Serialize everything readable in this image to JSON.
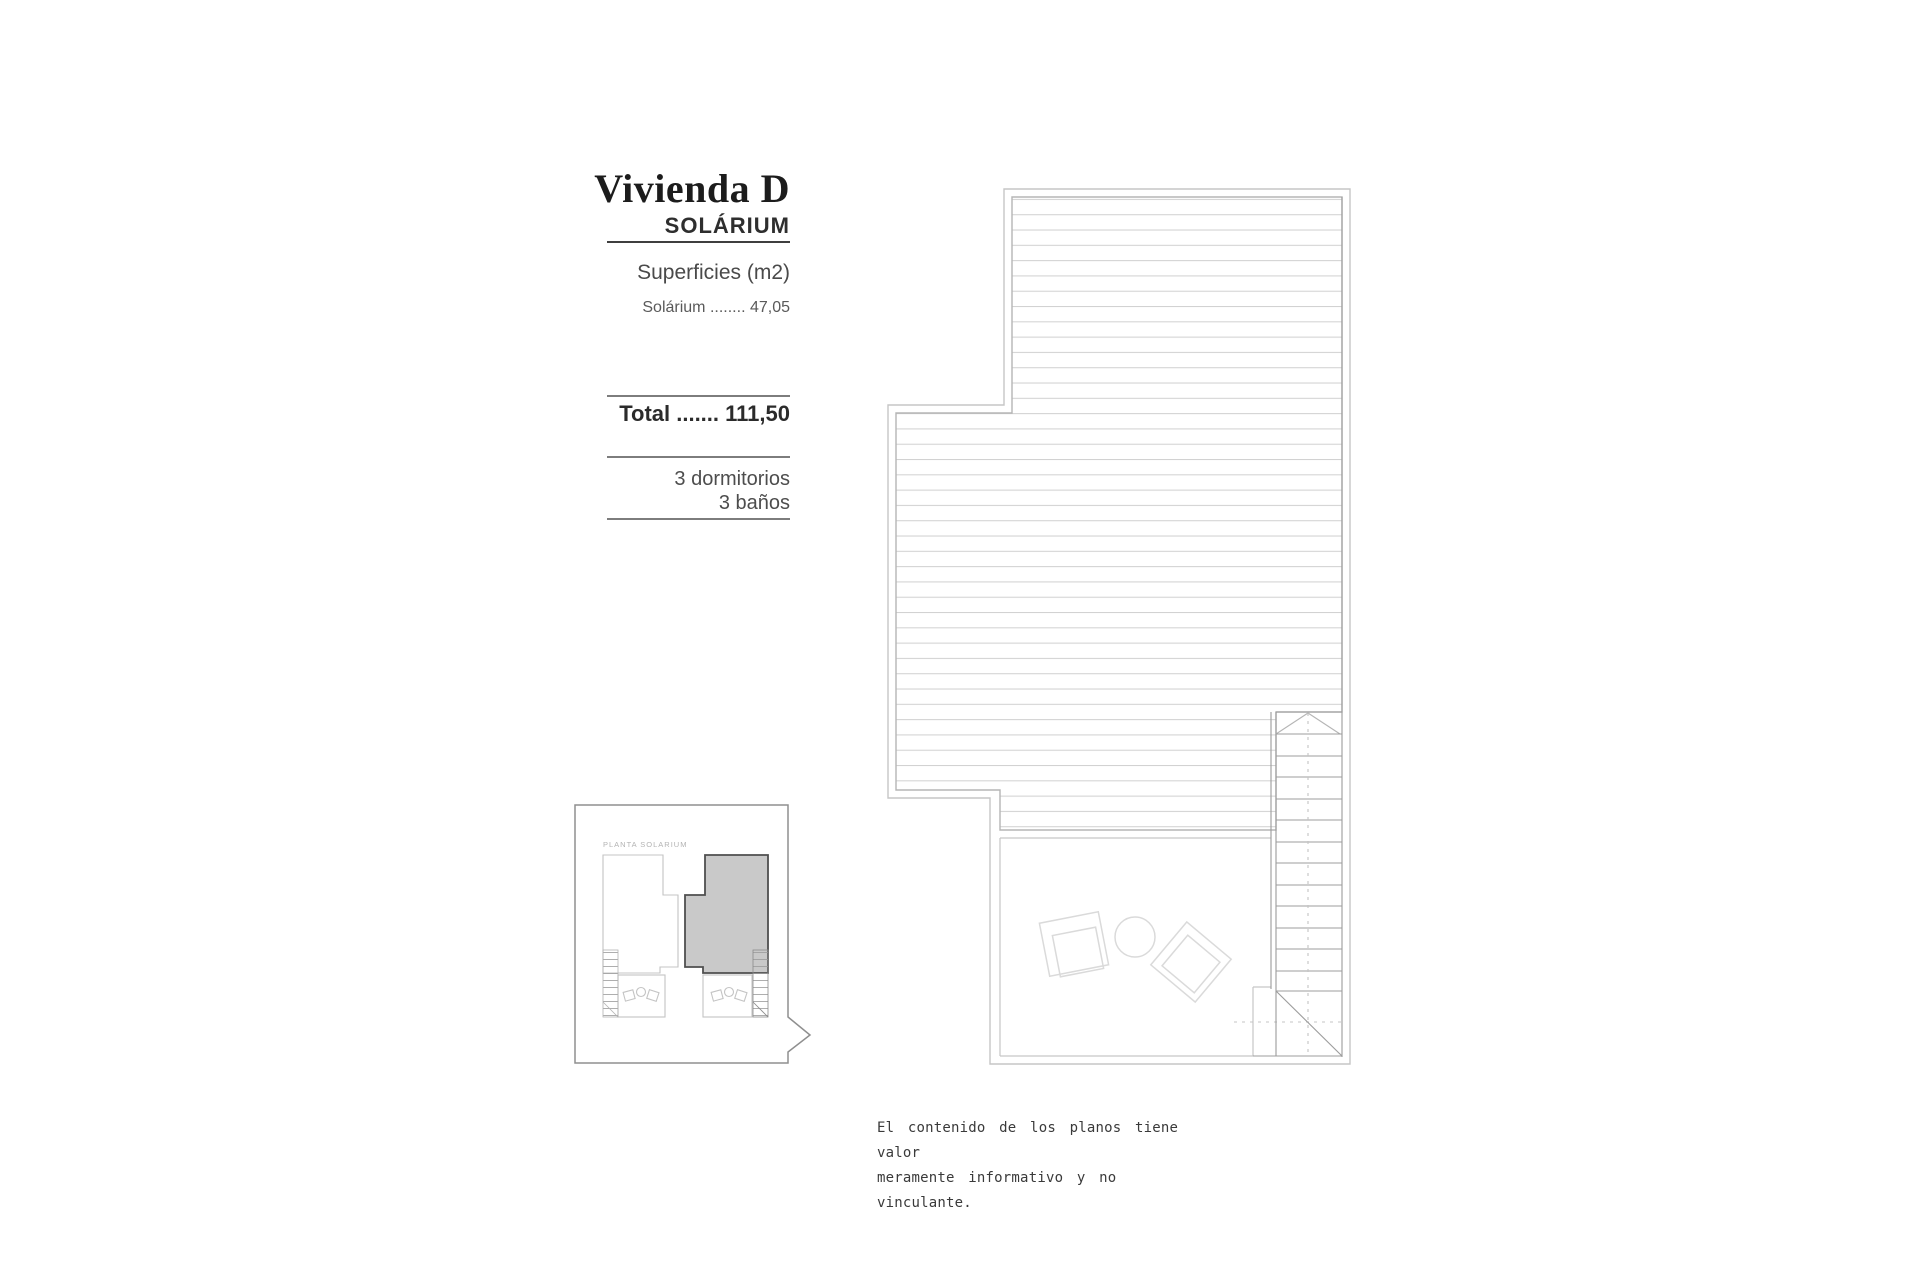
{
  "panel": {
    "title": "Vivienda D",
    "subtitle": "SOLÁRIUM",
    "surfaces_heading": "Superficies (m2)",
    "surface_row": "Solárium ........ 47,05",
    "total_row": "Total ....... 111,50",
    "bedrooms": "3 dormitorios",
    "bathrooms": "3 baños"
  },
  "key_plan": {
    "label": "PLANTA SOLARIUM"
  },
  "disclaimer": {
    "line1": "El contenido de los planos tiene valor",
    "line2": "meramente informativo y no vinculante."
  },
  "colors": {
    "highlight_fill": "#c9c9c9",
    "highlight_stroke": "#4f4f4f",
    "plan_line": "#b5b5b5",
    "hatch_line": "#d2d2d2",
    "rule_dark": "#3f3f3f",
    "rule_gray": "#7d7d7d"
  }
}
